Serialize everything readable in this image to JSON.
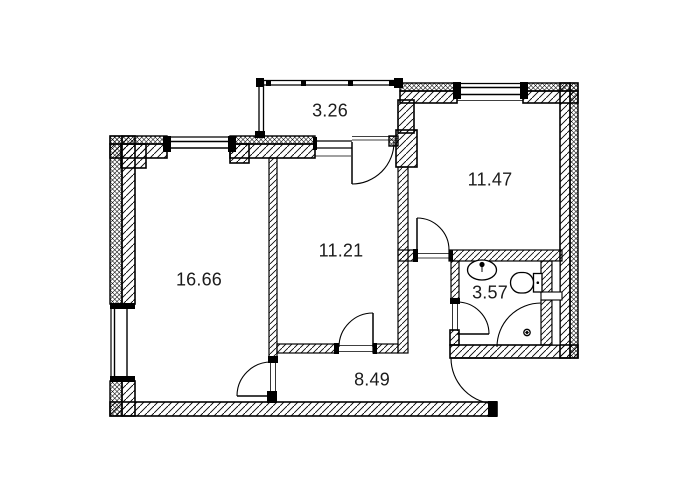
{
  "plan": {
    "background_color": "#ffffff",
    "line_color": "#000000",
    "text_color": "#1b1b1b",
    "rooms": [
      {
        "label": "3.26"
      },
      {
        "label": "11.47"
      },
      {
        "label": "16.66"
      },
      {
        "label": "11.21"
      },
      {
        "label": "3.57"
      },
      {
        "label": "8.49"
      }
    ],
    "fixtures": [
      {
        "icon": "sink-icon"
      },
      {
        "icon": "toilet-icon"
      },
      {
        "icon": "shower-icon"
      }
    ]
  }
}
